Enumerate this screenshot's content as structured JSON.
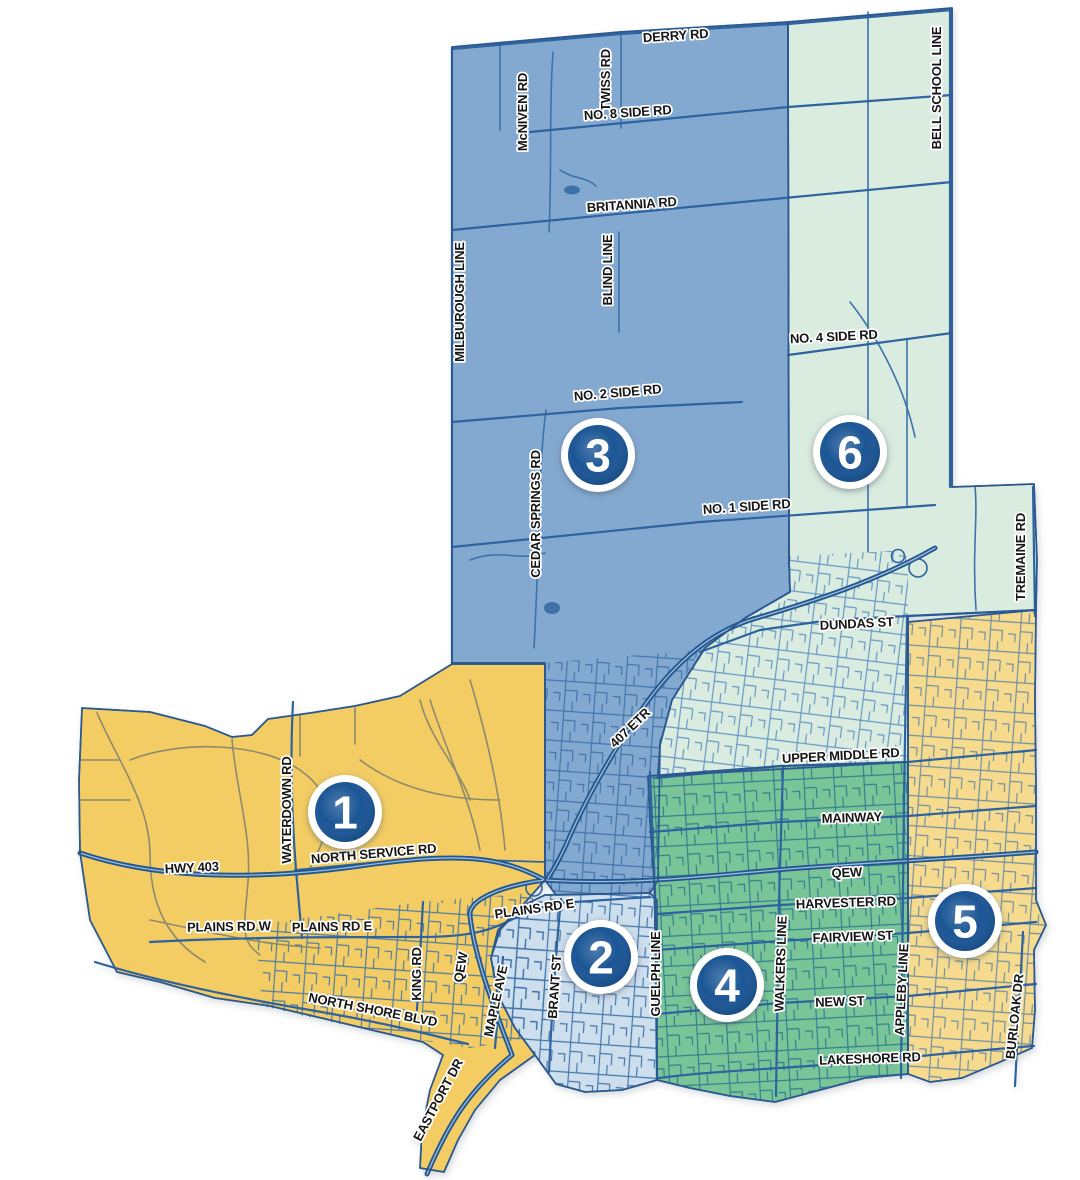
{
  "map": {
    "badge": {
      "fill": "#1d5796",
      "ring": "#ffffff"
    },
    "wards": [
      {
        "number": "1",
        "color": "#f3cd63"
      },
      {
        "number": "2",
        "color": "#cddeed"
      },
      {
        "number": "3",
        "color": "#84a9d1"
      },
      {
        "number": "4",
        "color": "#79c598"
      },
      {
        "number": "5",
        "color": "#f6db8e"
      },
      {
        "number": "6",
        "color": "#d9ecdf"
      }
    ],
    "road_colors": {
      "major": "#2e639f",
      "highway": "#24588f",
      "suburban": "#3e72a8",
      "rural_ward1": "#8d8a6d"
    },
    "road_labels": [
      {
        "text": "DERRY RD"
      },
      {
        "text": "McNIVEN RD"
      },
      {
        "text": "TWISS RD"
      },
      {
        "text": "NO. 8 SIDE RD"
      },
      {
        "text": "BELL SCHOOL LINE"
      },
      {
        "text": "BRITANNIA RD"
      },
      {
        "text": "BLIND LINE"
      },
      {
        "text": "MILBUROUGH LINE"
      },
      {
        "text": "NO. 4 SIDE RD"
      },
      {
        "text": "NO. 2 SIDE RD"
      },
      {
        "text": "CEDAR SPRINGS RD"
      },
      {
        "text": "NO. 1 SIDE RD"
      },
      {
        "text": "TREMAINE RD"
      },
      {
        "text": "DUNDAS ST"
      },
      {
        "text": "407 ETR"
      },
      {
        "text": "UPPER MIDDLE RD"
      },
      {
        "text": "MAINWAY"
      },
      {
        "text": "WATERDOWN RD"
      },
      {
        "text": "NORTH SERVICE RD"
      },
      {
        "text": "HWY 403"
      },
      {
        "text": "PLAINS RD W"
      },
      {
        "text": "PLAINS RD E"
      },
      {
        "text": "PLAINS RD E"
      },
      {
        "text": "QEW"
      },
      {
        "text": "HARVESTER RD"
      },
      {
        "text": "FAIRVIEW ST"
      },
      {
        "text": "KING RD"
      },
      {
        "text": "QEW"
      },
      {
        "text": "MAPLE AVE"
      },
      {
        "text": "BRANT ST"
      },
      {
        "text": "GUELPH LINE"
      },
      {
        "text": "WALKERS LINE"
      },
      {
        "text": "NEW ST"
      },
      {
        "text": "APPLEBY LINE"
      },
      {
        "text": "BURLOAK DR"
      },
      {
        "text": "NORTH SHORE BLVD"
      },
      {
        "text": "LAKESHORE RD"
      },
      {
        "text": "EASTPORT DR"
      }
    ]
  }
}
